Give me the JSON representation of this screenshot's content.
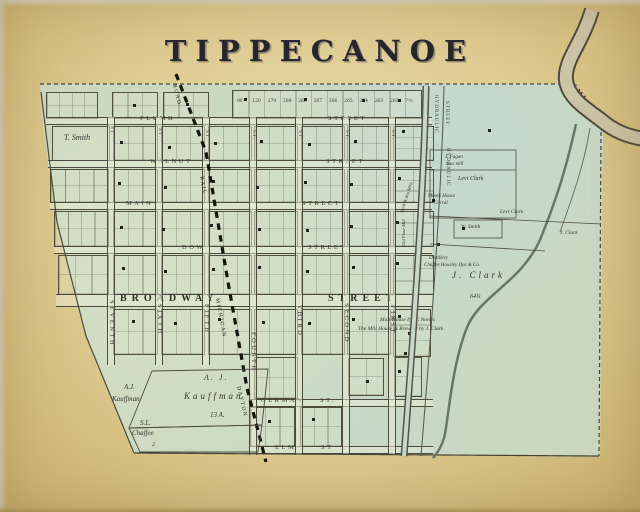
{
  "title": "TIPPECANOE",
  "map": {
    "streets_horizontal": [
      {
        "name": "PLUMB",
        "suffix": "STREET",
        "y": 117,
        "x": 46,
        "w": 386,
        "name_x": 140,
        "suffix_x": 328
      },
      {
        "name": "WALNUT",
        "suffix": "STREET",
        "y": 160,
        "x": 48,
        "w": 384,
        "name_x": 150,
        "suffix_x": 326
      },
      {
        "name": "MAIN",
        "suffix": "STREET",
        "y": 202,
        "x": 50,
        "w": 382,
        "name_x": 126,
        "suffix_x": 302
      },
      {
        "name": "DOW",
        "suffix": "STREET",
        "y": 246,
        "x": 54,
        "w": 378,
        "name_x": 182,
        "suffix_x": 308
      },
      {
        "name": "BROADWAY",
        "suffix": "STREET",
        "y": 294,
        "x": 56,
        "w": 376,
        "name_x": 120,
        "suffix_x": 328,
        "major": true
      },
      {
        "name": "GERMAN",
        "suffix": "ST.",
        "y": 399,
        "x": 249,
        "w": 184,
        "name_x": 261,
        "suffix_x": 320
      },
      {
        "name": "ELM",
        "suffix": "ST",
        "y": 446,
        "x": 249,
        "w": 184,
        "name_x": 275,
        "suffix_x": 321
      }
    ],
    "streets_vertical": [
      {
        "name": "SEVENTH",
        "st": "ST.",
        "x": 107,
        "y": 117,
        "h": 248,
        "label_y": 300,
        "st_y": 126
      },
      {
        "name": "SIXTH",
        "st": "ST.",
        "x": 155,
        "y": 117,
        "h": 248,
        "label_y": 304,
        "st_y": 128
      },
      {
        "name": "FIFTH",
        "st": "ST.",
        "x": 202,
        "y": 117,
        "h": 248,
        "label_y": 304,
        "st_y": 130
      },
      {
        "name": "FOURTH",
        "st": "ST.",
        "x": 249,
        "y": 117,
        "h": 338,
        "label_y": 332,
        "st_y": 130
      },
      {
        "name": "THIRD",
        "st": "ST.",
        "x": 295,
        "y": 117,
        "h": 338,
        "label_y": 305,
        "st_y": 130
      },
      {
        "name": "SECOND",
        "st": "ST.",
        "x": 342,
        "y": 117,
        "h": 338,
        "label_y": 303,
        "st_y": 130
      },
      {
        "name": "FIRST",
        "st": "ST.",
        "x": 388,
        "y": 117,
        "h": 338,
        "label_y": 305,
        "st_y": 130
      }
    ],
    "hydraulic_labels": [
      {
        "text": "HYDRAULIC",
        "x": 438,
        "y": 95
      },
      {
        "text": "STREET",
        "x": 449,
        "y": 101
      },
      {
        "text": "HYDRAULIC",
        "x": 450,
        "y": 148
      }
    ],
    "railroad": {
      "name": "DAYTON & MICHIGAN RAIL ROAD",
      "segments": [
        {
          "text": "ROAD",
          "x": 176,
          "y": 84,
          "rot": 77
        },
        {
          "text": "RAIL",
          "x": 203,
          "y": 176,
          "rot": 79
        },
        {
          "text": "MICHIGAN",
          "x": 219,
          "y": 298,
          "rot": 80
        },
        {
          "text": "DAYTON",
          "x": 240,
          "y": 386,
          "rot": 77
        }
      ]
    },
    "river": {
      "name": "MIAMI RIVER",
      "labels": [
        {
          "text": "MIAMI",
          "x": 567,
          "y": 72,
          "rot": 52
        },
        {
          "text": "RIVER",
          "x": 597,
          "y": 118,
          "rot": 18
        }
      ]
    },
    "owners": [
      {
        "text": "T. Smith",
        "x": 64,
        "y": 134,
        "s": 8
      },
      {
        "text": "J. Fagan",
        "x": 445,
        "y": 155,
        "s": 5
      },
      {
        "text": "Saw mill",
        "x": 446,
        "y": 162,
        "s": 5
      },
      {
        "text": "Levi Clark",
        "x": 458,
        "y": 176,
        "s": 6
      },
      {
        "text": "Miami House",
        "x": 428,
        "y": 194,
        "s": 5
      },
      {
        "text": "Corral",
        "x": 434,
        "y": 201,
        "s": 5
      },
      {
        "text": "Levi Clark",
        "x": 500,
        "y": 210,
        "s": 5.5
      },
      {
        "text": "W. Smith",
        "x": 461,
        "y": 225,
        "s": 5.5
      },
      {
        "text": "J. Clark",
        "x": 560,
        "y": 231,
        "s": 5.5
      },
      {
        "text": "Distillery",
        "x": 429,
        "y": 256,
        "s": 5
      },
      {
        "text": "Chaffee Housley Dye & Co.",
        "x": 424,
        "y": 263,
        "s": 5
      },
      {
        "text": "J. Clark",
        "x": 452,
        "y": 271,
        "s": 9,
        "ls": 3
      },
      {
        "text": "64¾",
        "x": 470,
        "y": 294,
        "s": 6
      },
      {
        "text": "Malt House by W. Norris",
        "x": 380,
        "y": 318,
        "s": 5.5
      },
      {
        "text": "The Mill House & Brewery by J. Clark",
        "x": 358,
        "y": 327,
        "s": 5.5
      },
      {
        "text": "A.J.",
        "x": 124,
        "y": 384,
        "s": 7
      },
      {
        "text": "Kauffman",
        "x": 112,
        "y": 396,
        "s": 7
      },
      {
        "text": "S.L.",
        "x": 140,
        "y": 420,
        "s": 7
      },
      {
        "text": "Chaffee",
        "x": 132,
        "y": 430,
        "s": 7
      },
      {
        "text": "2",
        "x": 152,
        "y": 442,
        "s": 6
      },
      {
        "text": "A. J.",
        "x": 204,
        "y": 374,
        "s": 8,
        "ls": 2
      },
      {
        "text": "Kauffman",
        "x": 184,
        "y": 392,
        "s": 9,
        "ls": 3
      },
      {
        "text": "13 A.",
        "x": 210,
        "y": 412,
        "s": 7
      },
      {
        "text": "Old Flour Mill",
        "x": 402,
        "y": 246,
        "s": 4.5,
        "rot": -90
      },
      {
        "text": "Herb & Bro Mills",
        "x": 400,
        "y": 212,
        "s": 4.5,
        "rot": -72
      }
    ],
    "lot_numbers_top": [
      "98",
      "120",
      "270",
      "269",
      "268",
      "267",
      "266",
      "265",
      "264",
      "263",
      "262",
      "7½"
    ],
    "blocks": [
      [
        232,
        90,
        188,
        27,
        12,
        1
      ],
      [
        46,
        92,
        50,
        25,
        4,
        2
      ],
      [
        112,
        92,
        44,
        25,
        3,
        2
      ],
      [
        163,
        92,
        44,
        25,
        3,
        2
      ],
      [
        52,
        126,
        56,
        33,
        1,
        1
      ],
      [
        113,
        126,
        43,
        33,
        3,
        2
      ],
      [
        161,
        126,
        42,
        33,
        3,
        2
      ],
      [
        208,
        126,
        42,
        33,
        3,
        2
      ],
      [
        254,
        126,
        42,
        33,
        3,
        2
      ],
      [
        301,
        126,
        42,
        33,
        3,
        2
      ],
      [
        347,
        126,
        42,
        33,
        3,
        2
      ],
      [
        393,
        126,
        39,
        33,
        2,
        3
      ],
      [
        50,
        169,
        57,
        32,
        4,
        2
      ],
      [
        113,
        169,
        43,
        32,
        3,
        2
      ],
      [
        161,
        169,
        42,
        32,
        3,
        2
      ],
      [
        208,
        169,
        42,
        32,
        3,
        2
      ],
      [
        254,
        169,
        42,
        32,
        3,
        2
      ],
      [
        301,
        169,
        42,
        32,
        3,
        2
      ],
      [
        347,
        169,
        42,
        32,
        3,
        2
      ],
      [
        393,
        169,
        39,
        32,
        2,
        3
      ],
      [
        54,
        211,
        53,
        34,
        4,
        2
      ],
      [
        113,
        211,
        43,
        34,
        3,
        2
      ],
      [
        161,
        211,
        42,
        34,
        3,
        2
      ],
      [
        208,
        211,
        42,
        34,
        3,
        2
      ],
      [
        254,
        211,
        42,
        34,
        3,
        2
      ],
      [
        301,
        211,
        42,
        34,
        3,
        2
      ],
      [
        347,
        211,
        42,
        34,
        3,
        2
      ],
      [
        393,
        211,
        39,
        34,
        2,
        3
      ],
      [
        58,
        255,
        49,
        38,
        3,
        2
      ],
      [
        113,
        255,
        43,
        38,
        3,
        2
      ],
      [
        161,
        255,
        42,
        38,
        3,
        2
      ],
      [
        208,
        255,
        42,
        38,
        3,
        2
      ],
      [
        254,
        255,
        42,
        38,
        3,
        2
      ],
      [
        301,
        255,
        42,
        38,
        3,
        2
      ],
      [
        347,
        255,
        42,
        38,
        3,
        2
      ],
      [
        393,
        255,
        39,
        38,
        2,
        3
      ],
      [
        113,
        309,
        43,
        44,
        3,
        2
      ],
      [
        161,
        309,
        42,
        44,
        3,
        2
      ],
      [
        208,
        309,
        42,
        44,
        3,
        2
      ],
      [
        254,
        309,
        42,
        44,
        3,
        2
      ],
      [
        301,
        309,
        42,
        44,
        3,
        2
      ],
      [
        347,
        309,
        42,
        44,
        3,
        2
      ],
      [
        393,
        309,
        36,
        46,
        2,
        3
      ],
      [
        254,
        357,
        42,
        40,
        3,
        2
      ],
      [
        348,
        358,
        34,
        36,
        2,
        2
      ],
      [
        394,
        357,
        26,
        38,
        2,
        2
      ],
      [
        250,
        407,
        43,
        38,
        3,
        2
      ],
      [
        300,
        407,
        40,
        38,
        3,
        2
      ]
    ],
    "buildings": [
      [
        133,
        104
      ],
      [
        186,
        103
      ],
      [
        244,
        98
      ],
      [
        304,
        98
      ],
      [
        362,
        99
      ],
      [
        398,
        99
      ],
      [
        120,
        141
      ],
      [
        168,
        146
      ],
      [
        214,
        142
      ],
      [
        260,
        140
      ],
      [
        308,
        143
      ],
      [
        354,
        140
      ],
      [
        402,
        130
      ],
      [
        118,
        182
      ],
      [
        164,
        186
      ],
      [
        212,
        180
      ],
      [
        256,
        186
      ],
      [
        304,
        181
      ],
      [
        350,
        183
      ],
      [
        398,
        177
      ],
      [
        120,
        226
      ],
      [
        162,
        228
      ],
      [
        210,
        224
      ],
      [
        258,
        228
      ],
      [
        306,
        229
      ],
      [
        350,
        225
      ],
      [
        396,
        221
      ],
      [
        462,
        227
      ],
      [
        122,
        267
      ],
      [
        164,
        270
      ],
      [
        212,
        268
      ],
      [
        258,
        266
      ],
      [
        306,
        270
      ],
      [
        352,
        266
      ],
      [
        396,
        262
      ],
      [
        132,
        320
      ],
      [
        174,
        322
      ],
      [
        218,
        318
      ],
      [
        262,
        321
      ],
      [
        308,
        322
      ],
      [
        352,
        318
      ],
      [
        398,
        315
      ],
      [
        268,
        420
      ],
      [
        312,
        418
      ],
      [
        366,
        380
      ],
      [
        398,
        370
      ],
      [
        488,
        129
      ],
      [
        432,
        199
      ],
      [
        437,
        243
      ],
      [
        408,
        332
      ],
      [
        404,
        352
      ]
    ]
  }
}
